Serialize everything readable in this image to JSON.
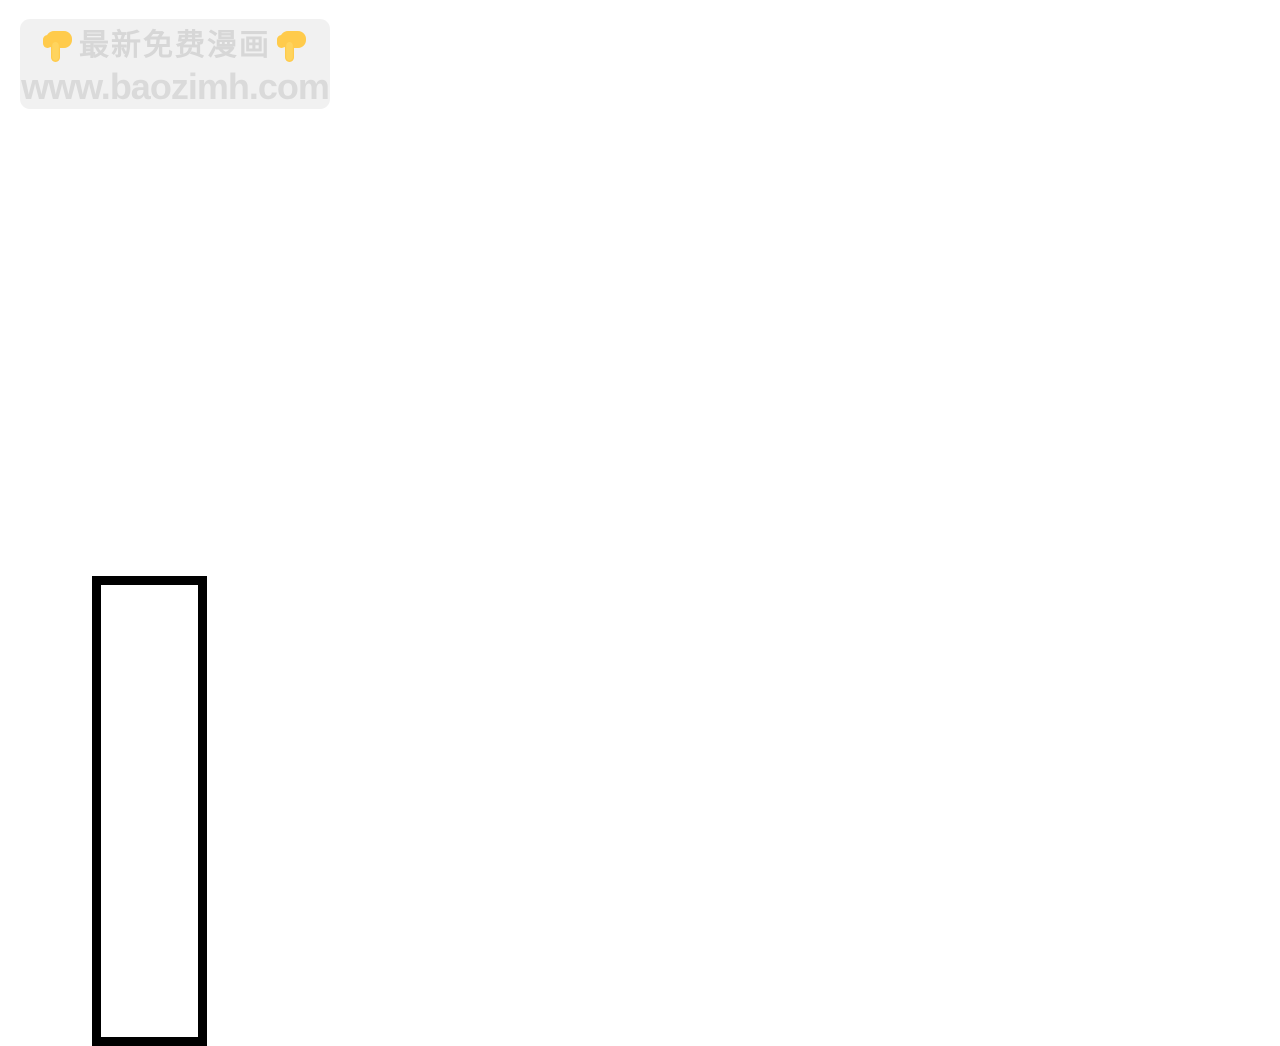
{
  "page": {
    "type": "comic-reader-page",
    "background_color": "#ffffff"
  },
  "watermark": {
    "title": "最新免费漫画",
    "site_url": "www.baozimh.com",
    "emoji_name": "backhand-index-pointing-down",
    "badge_bg_color": "#f1f1f1",
    "text_color": "#d7d7d7",
    "emoji_color": "#ffcb4c"
  },
  "comic": {
    "panel_outline_color": "#000000"
  }
}
